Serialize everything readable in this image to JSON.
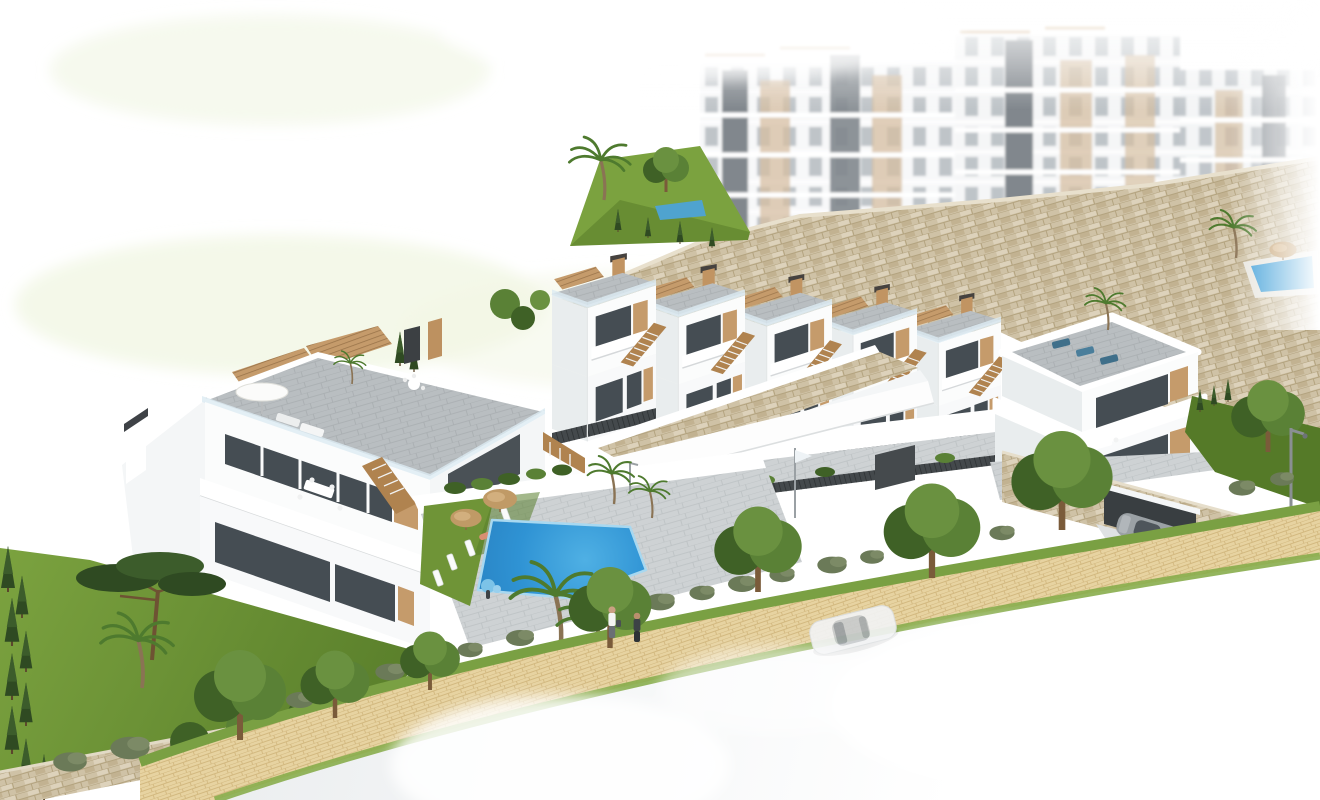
{
  "image_type": "architectural_aerial_render",
  "scene_label": "Aerial 3D render of a hillside residential complex with townhouses, apartment blocks, communal pool, landscaped path and road",
  "palette": {
    "tan": "#c59b6b",
    "tanDark": "#b0834f",
    "paver": "#b9bec1",
    "paverLight": "#ced2d4",
    "glassDark": "#454d53",
    "balustrade": "#dcebf2",
    "fence": "#44494c",
    "grass": "#6f9437",
    "grassDark": "#587d2b",
    "leaf": "#5a8136",
    "leafDark": "#3f6126",
    "olive": "#6b7a58",
    "conifer": "#2f4a22",
    "stoneBase": "#cfc2a6",
    "stoneDark": "#b9a884",
    "stoneLight": "#ddd2bb",
    "poolBlue": "#2f93d4",
    "poolBlueLight": "#5cb6e6",
    "pathBeige": "#e7d3a1",
    "pathJoint": "#d2b87f",
    "roadGray": "#e5e8ea",
    "carWhite": "#f2f3f4",
    "carGray": "#9ba1a5",
    "trunkBrown": "#7a5b3a",
    "white": "#ffffff"
  },
  "scene": {
    "background": {
      "label": "white sky / faded golf green halo top-left"
    },
    "apartment_blocks": {
      "count": 3,
      "label": "faded white apartment buildings with tan panels and dark cores"
    },
    "stone_retaining_wall": {
      "label": "sand-colored stone retaining wall bands"
    },
    "hillside_garden": {
      "label": "upper garden terrace with palm, tree and tiny pool"
    },
    "rooftop_mini_pool": {
      "label": "small blue pool with umbrella at far top right"
    },
    "townhouse_row": {
      "units": 5,
      "label": "white townhouses with roof terraces, tan pergolas, external stairs"
    },
    "left_villa": {
      "label": "two-storey white villa block with roof terrace, white parasol, dining sets"
    },
    "right_villa": {
      "label": "curved white villa over stone garage wall with driveway"
    },
    "pool_area": {
      "label": "communal swimming pool",
      "umbrellas": 2,
      "sun_loungers": 7
    },
    "vegetation": {
      "conifer_hedge": 9,
      "palms": 4,
      "pine_trees": 1,
      "path_trees": 7,
      "shrubs": "many"
    },
    "footpath": {
      "label": "beige brick footpath with grass borders"
    },
    "road": {
      "label": "light asphalt road fading to white"
    },
    "vehicles": {
      "white_sedan": 1,
      "gray_coupe": 1
    },
    "pedestrians": 2,
    "street_lamp": 1,
    "flag_pole": 1
  }
}
